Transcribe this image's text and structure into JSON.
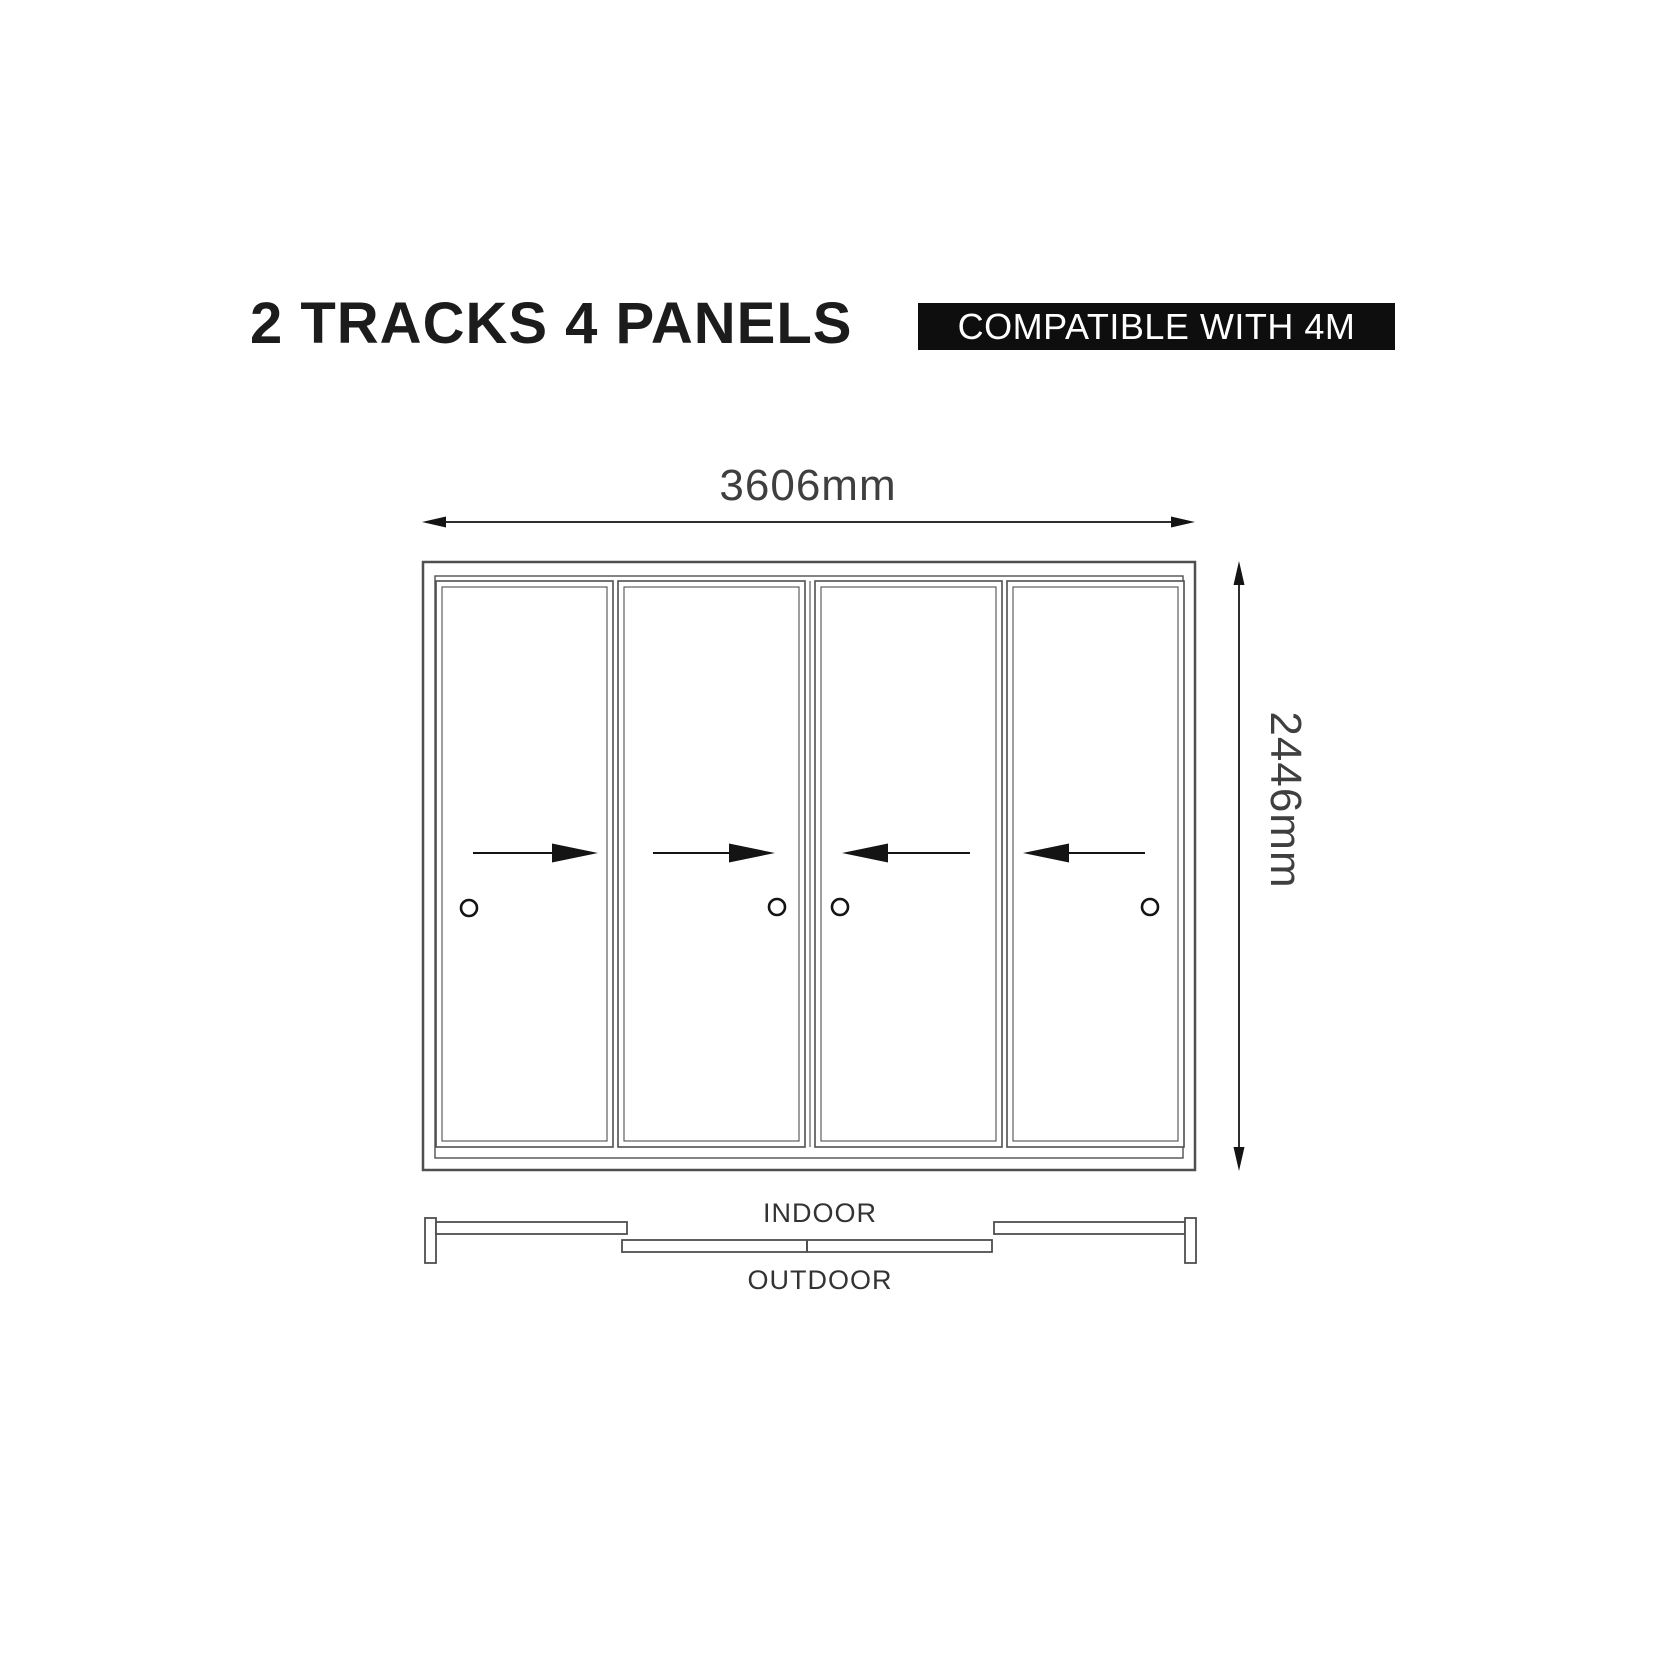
{
  "header": {
    "title": "2 TRACKS 4 PANELS",
    "badge": "COMPATIBLE WITH 4M"
  },
  "diagram": {
    "width_dimension": "3606mm",
    "height_dimension": "2446mm",
    "indoor_label": "INDOOR",
    "outdoor_label": "OUTDOOR",
    "panel_count": 4,
    "panel_arrows": [
      "right",
      "right",
      "left",
      "left"
    ]
  },
  "colors": {
    "background": "#ffffff",
    "line": "#4f4f4f",
    "accent_black": "#141414",
    "badge_bg": "#0e0e0e",
    "badge_text": "#ffffff",
    "title": "#1c1c1c",
    "dim_text": "#3f3f3f"
  }
}
